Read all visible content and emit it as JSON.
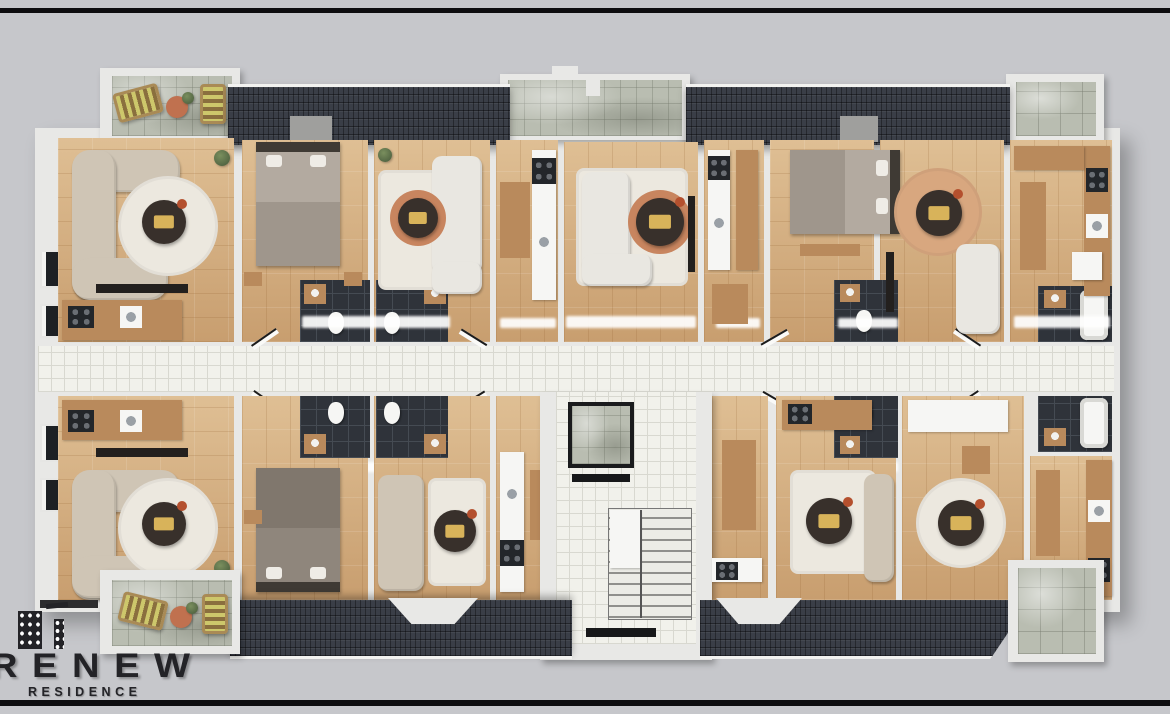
{
  "scene": {
    "description": "Top-down 3D architectural rendering of one storey of an apartment building, viewed from directly above, on a plain grey backdrop with a dark rule line across the top and bottom of the frame.",
    "view": "top-down 3D floor plan"
  },
  "logo": {
    "brand": "RENEW",
    "tagline": "RESIDENCE",
    "icon": "buildings-icon"
  },
  "structures": {
    "roofs": [
      "roof-top-left",
      "roof-top-right",
      "roof-bottom-left",
      "roof-bottom-right"
    ],
    "outdoor": [
      "balcony-top-left",
      "terrace-top-center",
      "balcony-top-right",
      "balcony-bottom-left",
      "balcony-bottom-right"
    ],
    "circulation": [
      "central-corridor",
      "entrance-lobby",
      "staircase",
      "elevator"
    ],
    "room_types": [
      "living-room",
      "bedroom",
      "kitchen",
      "dining-area",
      "bathroom"
    ]
  },
  "furniture_inventory": [
    "sectional-sofa",
    "sofa",
    "coffee-table",
    "round-rug",
    "bed",
    "nightstand",
    "dining-table",
    "kitchen-counter",
    "stove",
    "sink",
    "refrigerator",
    "bathtub",
    "toilet",
    "vanity",
    "tv-console",
    "lounge-chair",
    "plant",
    "doormat"
  ],
  "palette": {
    "bg": "#c6c7cb",
    "frame": "#0d0d0f",
    "wall": "#e8e8e6",
    "roof": "#3a3e47",
    "roof-ridge": "#f2f2f0",
    "stone": "#b9bdb1",
    "wood": "#dfbf94",
    "wood-grain": "#c89e6f",
    "corridor": "#f1f1eb",
    "tile-line": "#d8d8d0",
    "bath": "#2f333a",
    "bath-line": "#454b53",
    "sofa": "#cfc5b5",
    "sofa-white": "#e9e7e1",
    "rug": "#ece8df",
    "rug-terra": "#d8a77f",
    "table-dark": "#38302b",
    "table-gold": "#d8b35a",
    "furn-wood": "#b98a5c",
    "bed": "#b3aaa0",
    "bed-dark": "#8f867c",
    "headboard": "#3f3a34",
    "fixture": "#f6f6f4",
    "stove": "#23262a",
    "terra": "#c0714f",
    "lounge-a": "#cdc76b",
    "lounge-b": "#8a6f3e",
    "glow": "#ffffff",
    "ink": "#232327"
  }
}
